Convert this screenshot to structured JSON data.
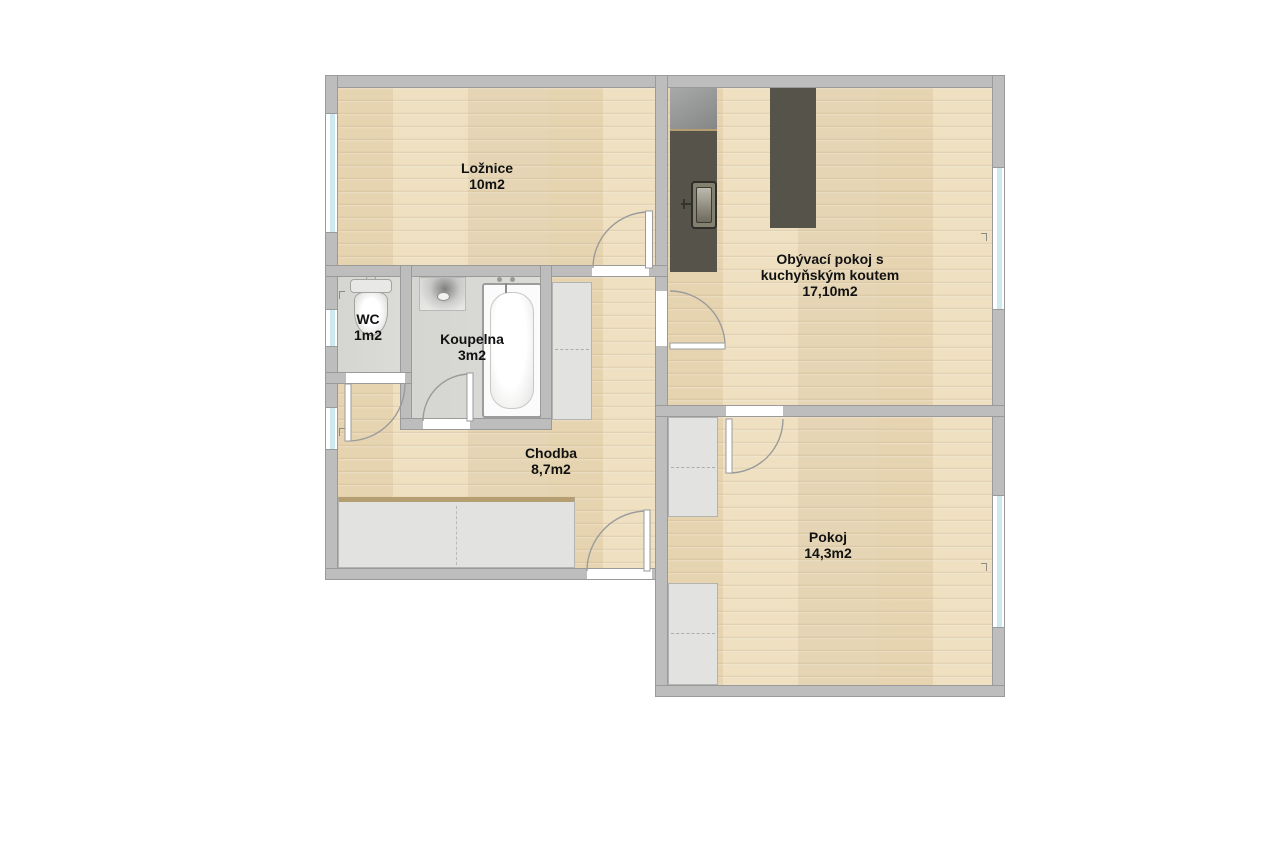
{
  "floorplan": {
    "rooms": [
      {
        "id": "loznice",
        "name": "Ložnice",
        "area": "10m2"
      },
      {
        "id": "obyvaci-pokoj",
        "name_line1": "Obývací pokoj s",
        "name_line2": "kuchyňským koutem",
        "area": "17,10m2"
      },
      {
        "id": "wc",
        "name": "WC",
        "area": "1m2"
      },
      {
        "id": "koupelna",
        "name": "Koupelna",
        "area": "3m2"
      },
      {
        "id": "chodba",
        "name": "Chodba",
        "area": "8,7m2"
      },
      {
        "id": "pokoj",
        "name": "Pokoj",
        "area": "14,3m2"
      }
    ],
    "fixtures": [
      "refrigerator",
      "kitchen-counter",
      "kitchen-sink",
      "kitchen-island",
      "toilet",
      "washbasin",
      "bathtub",
      "wardrobe-hallway",
      "wardrobe-hall-tall",
      "wardrobe-pokoj-north",
      "wardrobe-pokoj-south",
      "entrance-door",
      "interior-door",
      "window"
    ],
    "colors": {
      "background": "#ffffff",
      "wall": "#bdbdbd",
      "wall-edge": "#9a9a9a",
      "floor-wood": "#ecdcba",
      "floor-tile": "#d9d9d5",
      "counter": "#56534a",
      "counter-trim": "#b59e72",
      "furniture": "#e2e2e0",
      "furniture-edge": "#b3b3b1",
      "glass": "#cfe9f0",
      "door": "#9b9b9b",
      "label": "#111111"
    }
  }
}
